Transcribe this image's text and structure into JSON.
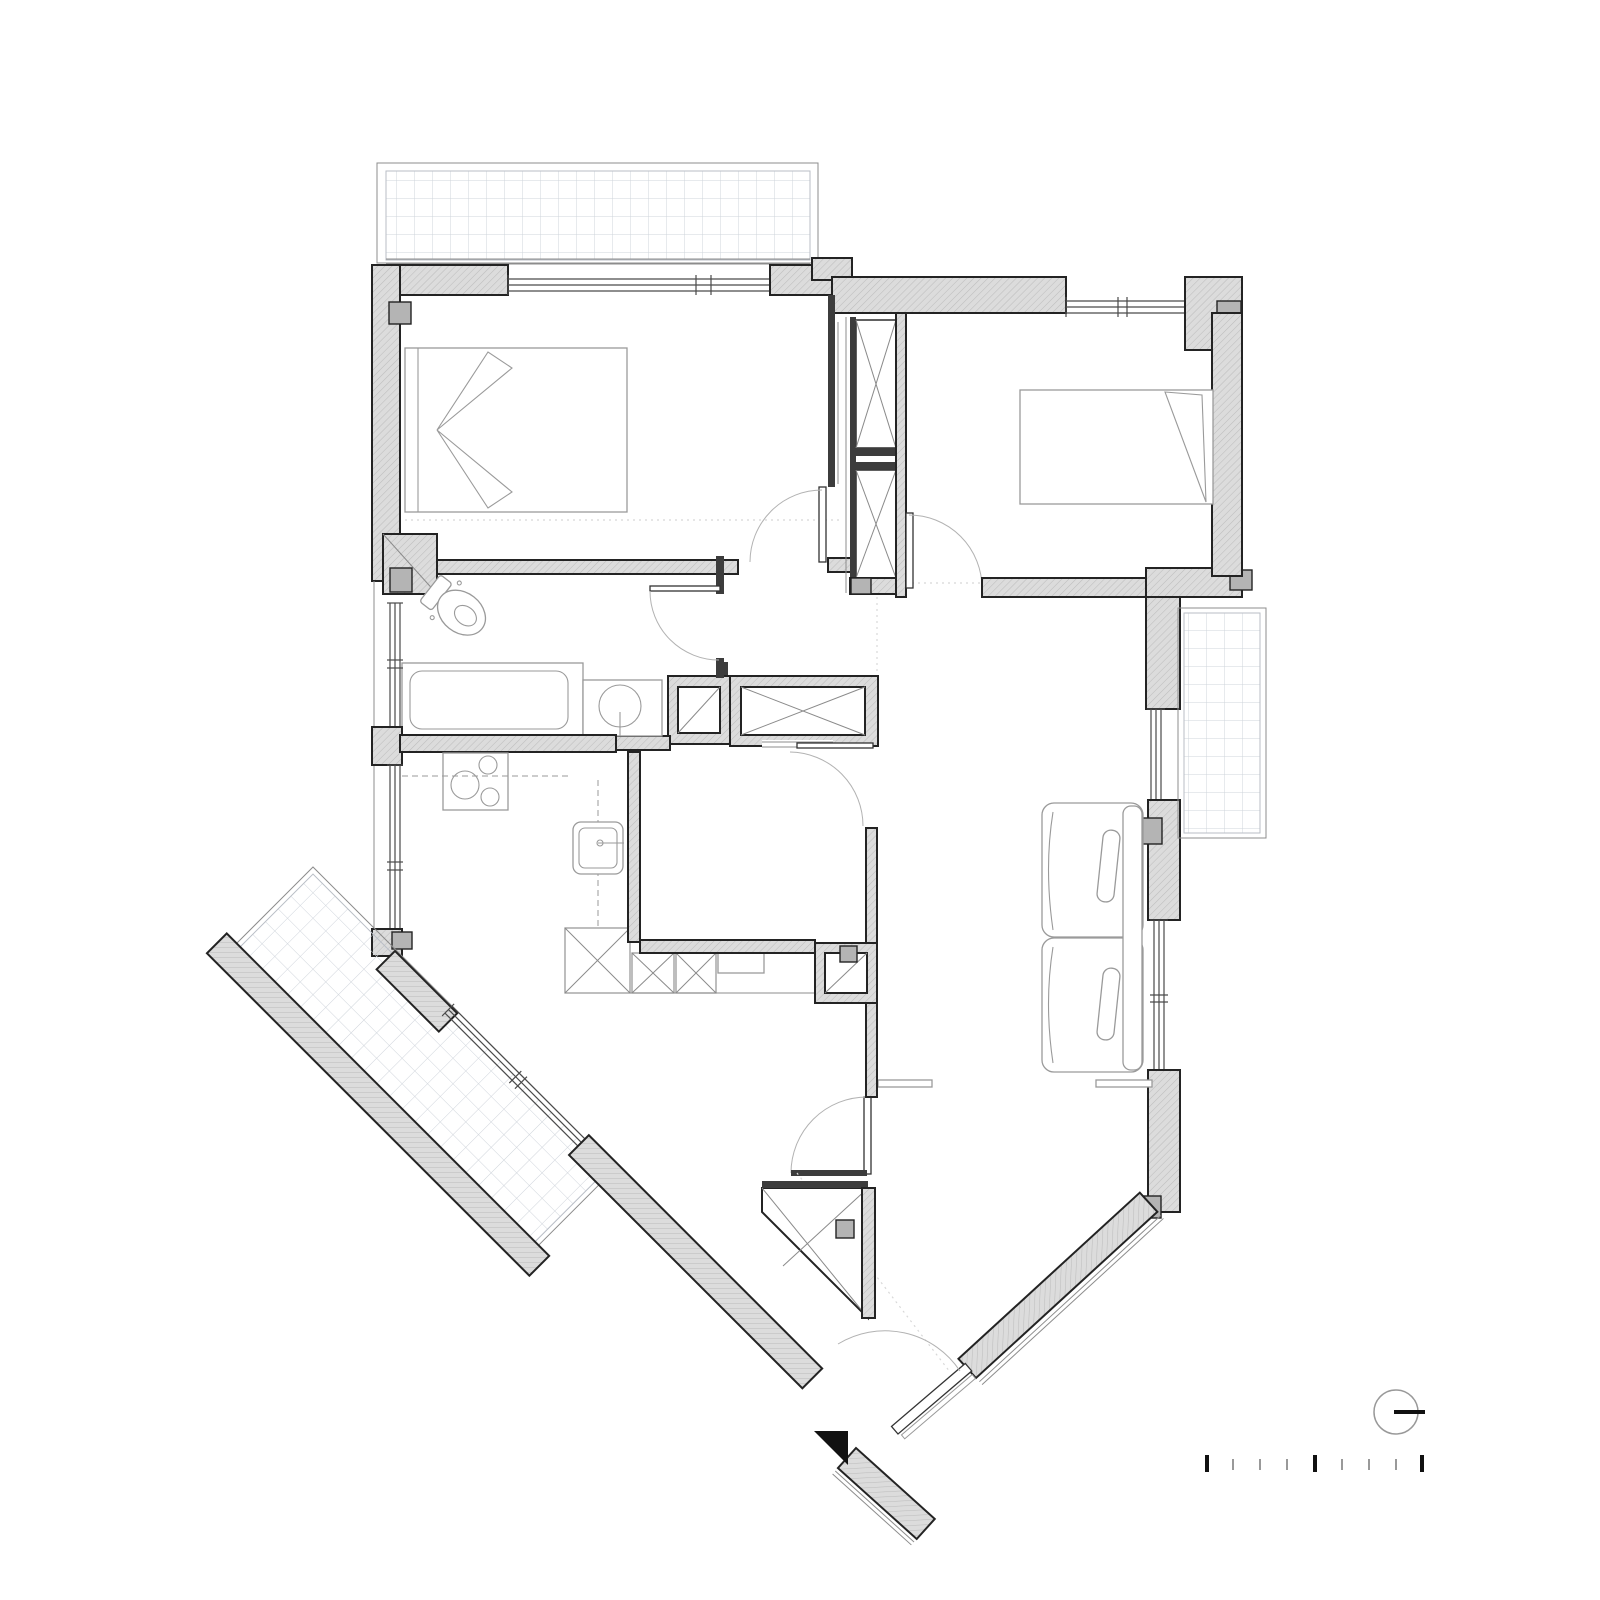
{
  "page": {
    "background": "#ffffff",
    "kind": "architectural floor plan of an apartment, top-down line drawing, no text labels visible"
  },
  "colors": {
    "background": "#ffffff",
    "wall_fill": "#dcdcdc",
    "wall_hatch": "#bdbdbd",
    "wall_outline": "#232323",
    "partition_dark": "#3c3c3c",
    "column_fill": "#b4b4b4",
    "window_line": "#4a4a4a",
    "furniture_line": "#9a9a9a",
    "door_arc": "#b2b2b2",
    "tile_grid_line": "#cfd4db",
    "marker_black": "#111111",
    "minor_tick": "#999999"
  },
  "plan": {
    "rooms": [
      "balcony-north",
      "bedroom-1",
      "hall-with-wardrobes",
      "bedroom-2",
      "bathroom",
      "kitchen",
      "utility-room",
      "dining-area",
      "living-room",
      "balcony-east",
      "balcony-southwest",
      "entrance"
    ],
    "fixtures": [
      "double-bed",
      "single-bed",
      "toilet",
      "bathtub",
      "washbasin",
      "cooktop",
      "kitchen-sink",
      "refrigerator-x-box",
      "cabinet-x-boxes",
      "two-seat-sofa",
      "console-shelf",
      "wardrobe-x-boxes",
      "duct-shaft-x"
    ],
    "door_count": 6,
    "window_count": 7,
    "shaft_count": 4
  },
  "symbols": {
    "north_indicator": {
      "shape": "circle-with-horizontal-bar",
      "color": "#111111"
    },
    "entrance_marker": {
      "shape": "solid-right-triangle",
      "color": "#111111"
    },
    "scale_bar": {
      "tick_count": 9,
      "major_tick_indices": [
        1,
        5,
        9
      ],
      "major_color": "#111111",
      "minor_color": "#999999"
    }
  }
}
